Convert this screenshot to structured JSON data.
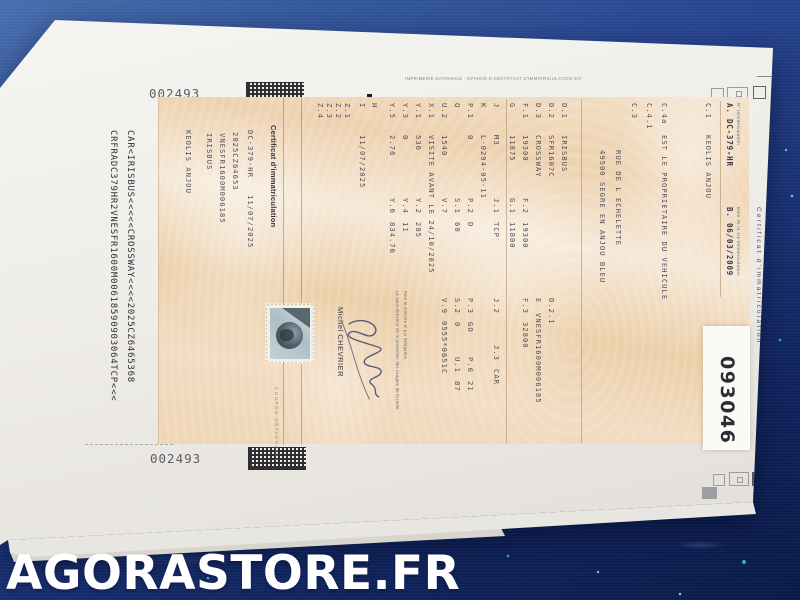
{
  "watermark": "AGORASTORE.FR",
  "sheet": {
    "serial_top": "002493",
    "serial_bottom": "002493",
    "print_line": "IMPRIMERIE NATIONALE - EPHIGIE E-CERTIFICAT D'IMMATRICULATION SIV",
    "auction_label": "093046"
  },
  "certificate": {
    "title": "Certificat d'immatriculation",
    "header": {
      "reg_label": "N° immatriculation",
      "reg_value": "A. DC-379-HR",
      "date_label": "Date de la 1re immatriculation",
      "date_value": "B. 06/03/2009"
    },
    "rows": [
      {
        "y": 52,
        "cells": [
          {
            "x": 8,
            "t": "C.1"
          },
          {
            "x": 40,
            "t": "KEOLIS ANJOU"
          }
        ]
      },
      {
        "y": 96,
        "cells": [
          {
            "x": 8,
            "t": "C.4a"
          },
          {
            "x": 40,
            "t": "EST LE PROPRIETAIRE DU VEHICULE"
          }
        ]
      },
      {
        "y": 111,
        "cells": [
          {
            "x": 8,
            "t": "C.4.1"
          }
        ]
      },
      {
        "y": 126,
        "cells": [
          {
            "x": 8,
            "t": "C.3"
          }
        ]
      },
      {
        "y": 142,
        "cells": [
          {
            "x": 55,
            "t": "RUE DE L ECHELETTE"
          }
        ]
      },
      {
        "y": 158,
        "cells": [
          {
            "x": 55,
            "t": "49500 SEGRE EN ANJOU BLEU"
          }
        ]
      },
      {
        "y": 196,
        "cells": [
          {
            "x": 8,
            "t": "D.1"
          },
          {
            "x": 40,
            "t": "IRISBUS"
          }
        ]
      },
      {
        "y": 209,
        "cells": [
          {
            "x": 8,
            "t": "D.2"
          },
          {
            "x": 40,
            "t": "SFR1607C"
          },
          {
            "x": 203,
            "t": "D.2.1"
          }
        ]
      },
      {
        "y": 222,
        "cells": [
          {
            "x": 8,
            "t": "D.3"
          },
          {
            "x": 40,
            "t": "CROSSWAY"
          },
          {
            "x": 203,
            "t": "E"
          },
          {
            "x": 218,
            "t": "VNESFR1600M006185"
          }
        ]
      },
      {
        "y": 235,
        "cells": [
          {
            "x": 8,
            "t": "F.1"
          },
          {
            "x": 40,
            "t": "19300"
          },
          {
            "x": 103,
            "t": "F.2"
          },
          {
            "x": 127,
            "t": "19300"
          },
          {
            "x": 203,
            "t": "F.3"
          },
          {
            "x": 227,
            "t": "32800"
          }
        ]
      },
      {
        "y": 248,
        "cells": [
          {
            "x": 8,
            "t": "G"
          },
          {
            "x": 40,
            "t": "11875"
          },
          {
            "x": 103,
            "t": "G.1"
          },
          {
            "x": 127,
            "t": "11800"
          }
        ]
      },
      {
        "y": 264,
        "cells": [
          {
            "x": 8,
            "t": "J"
          },
          {
            "x": 40,
            "t": "M3"
          },
          {
            "x": 103,
            "t": "J.1"
          },
          {
            "x": 127,
            "t": "TCP"
          },
          {
            "x": 203,
            "t": "J.2"
          },
          {
            "x": 250,
            "t": "J.3"
          },
          {
            "x": 274,
            "t": "CAR"
          }
        ]
      },
      {
        "y": 277,
        "cells": [
          {
            "x": 8,
            "t": "K"
          },
          {
            "x": 40,
            "t": "L-0294-05-11"
          }
        ]
      },
      {
        "y": 290,
        "cells": [
          {
            "x": 8,
            "t": "P.1"
          },
          {
            "x": 40,
            "t": "0"
          },
          {
            "x": 103,
            "t": "P.2"
          },
          {
            "x": 127,
            "t": "D"
          },
          {
            "x": 203,
            "t": "P.3"
          },
          {
            "x": 227,
            "t": "GO"
          },
          {
            "x": 262,
            "t": "P.6"
          },
          {
            "x": 286,
            "t": "21"
          }
        ]
      },
      {
        "y": 303,
        "cells": [
          {
            "x": 8,
            "t": "Q"
          },
          {
            "x": 103,
            "t": "S.1"
          },
          {
            "x": 127,
            "t": "60"
          },
          {
            "x": 203,
            "t": "S.2"
          },
          {
            "x": 227,
            "t": "0"
          },
          {
            "x": 262,
            "t": "U.1"
          },
          {
            "x": 286,
            "t": "87"
          }
        ]
      },
      {
        "y": 316,
        "cells": [
          {
            "x": 8,
            "t": "U.2"
          },
          {
            "x": 40,
            "t": "1540"
          },
          {
            "x": 103,
            "t": "V.7"
          },
          {
            "x": 203,
            "t": "V.9"
          },
          {
            "x": 226,
            "t": "0555*0651C"
          }
        ]
      },
      {
        "y": 329,
        "cells": [
          {
            "x": 8,
            "t": "X.1"
          },
          {
            "x": 40,
            "t": "VISITE AVANT LE 24/10/2025"
          }
        ]
      },
      {
        "y": 342,
        "cells": [
          {
            "x": 8,
            "t": "Y.1"
          },
          {
            "x": 40,
            "t": "536"
          },
          {
            "x": 103,
            "t": "Y.2"
          },
          {
            "x": 127,
            "t": "285"
          }
        ]
      },
      {
        "y": 355,
        "cells": [
          {
            "x": 8,
            "t": "Y.3"
          },
          {
            "x": 40,
            "t": "0"
          },
          {
            "x": 103,
            "t": "Y.4"
          },
          {
            "x": 127,
            "t": "11"
          }
        ]
      },
      {
        "y": 368,
        "cells": [
          {
            "x": 8,
            "t": "Y.5"
          },
          {
            "x": 40,
            "t": "2.76"
          },
          {
            "x": 103,
            "t": "Y.6"
          },
          {
            "x": 127,
            "t": "834.76"
          }
        ]
      },
      {
        "y": 386,
        "cells": [
          {
            "x": 8,
            "t": "H"
          }
        ]
      },
      {
        "y": 398,
        "cells": [
          {
            "x": 8,
            "t": "I"
          },
          {
            "x": 40,
            "t": "11/07/2025"
          }
        ]
      },
      {
        "y": 413,
        "cells": [
          {
            "x": 8,
            "t": "Z.1"
          }
        ]
      },
      {
        "y": 422,
        "cells": [
          {
            "x": 8,
            "t": "Z.2"
          }
        ]
      },
      {
        "y": 431,
        "cells": [
          {
            "x": 8,
            "t": "Z.3"
          }
        ]
      },
      {
        "y": 440,
        "cells": [
          {
            "x": 8,
            "t": "Z.4"
          }
        ]
      },
      {
        "y": 510,
        "cells": [
          {
            "x": 35,
            "t": "DC-379-HR"
          },
          {
            "x": 100,
            "t": "11/07/2025"
          }
        ]
      },
      {
        "y": 525,
        "cells": [
          {
            "x": 37,
            "t": "2025CZ64653"
          }
        ]
      },
      {
        "y": 538,
        "cells": [
          {
            "x": 38,
            "t": "VNESFR1600M006185"
          }
        ]
      },
      {
        "y": 551,
        "cells": [
          {
            "x": 38,
            "t": "IRISBUS"
          }
        ]
      },
      {
        "y": 572,
        "cells": [
          {
            "x": 35,
            "t": "KEOLIS ANJOU"
          }
        ]
      }
    ],
    "coupon_title": "Certificat d'immatriculation",
    "coupon_edge_label": "COUPON DÉTACHABLE",
    "official": {
      "line1": "Pour le ministre et par délégation,",
      "line2": "Le sous-directeur de la protection des usagers de la route",
      "signer": "Michel CHEVRIER"
    },
    "mrz_line1": "CAR<IRISBUS<<<<<CROSSWAY<<<<2025CZ6465368",
    "mrz_line2": "CRFRADC379HR2VNESFR1600M00618590903064TCP<<<"
  }
}
